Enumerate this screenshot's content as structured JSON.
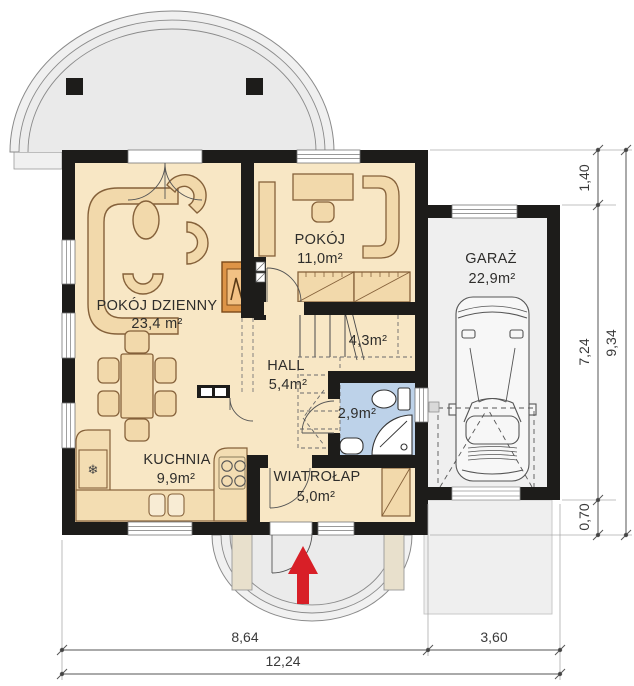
{
  "plan": {
    "rooms": {
      "living": {
        "name": "POKÓJ DZIENNY",
        "area": "23,4 m²"
      },
      "room": {
        "name": "POKÓJ",
        "area": "11,0m²"
      },
      "hall": {
        "name": "HALL",
        "area": "5,4m²"
      },
      "stairs": {
        "area": "4,3m²"
      },
      "bathroom": {
        "area": "2,9m²"
      },
      "kitchen": {
        "name": "KUCHNIA",
        "area": "9,9m²"
      },
      "vestibule": {
        "name": "WIATROŁAP",
        "area": "5,0m²"
      },
      "garage": {
        "name": "GARAŻ",
        "area": "22,9m²"
      }
    },
    "dimensions": {
      "bottom": {
        "house_width": "8,64",
        "garage_width": "3,60",
        "total_width": "12,24"
      },
      "right": {
        "front_offset": "1,40",
        "garage_depth": "7,24",
        "rear_offset": "0,70",
        "total_depth": "9,34"
      }
    },
    "icons": {
      "fridge": "❄"
    },
    "colors": {
      "wall": "#1d1c1a",
      "floor": "#f8e7c5",
      "furniture": "#f2d9ab",
      "bath_floor": "#bdd2e9",
      "paving": "#efefef",
      "accent_red": "#d81f27",
      "fireplace": "#dd9447"
    }
  }
}
